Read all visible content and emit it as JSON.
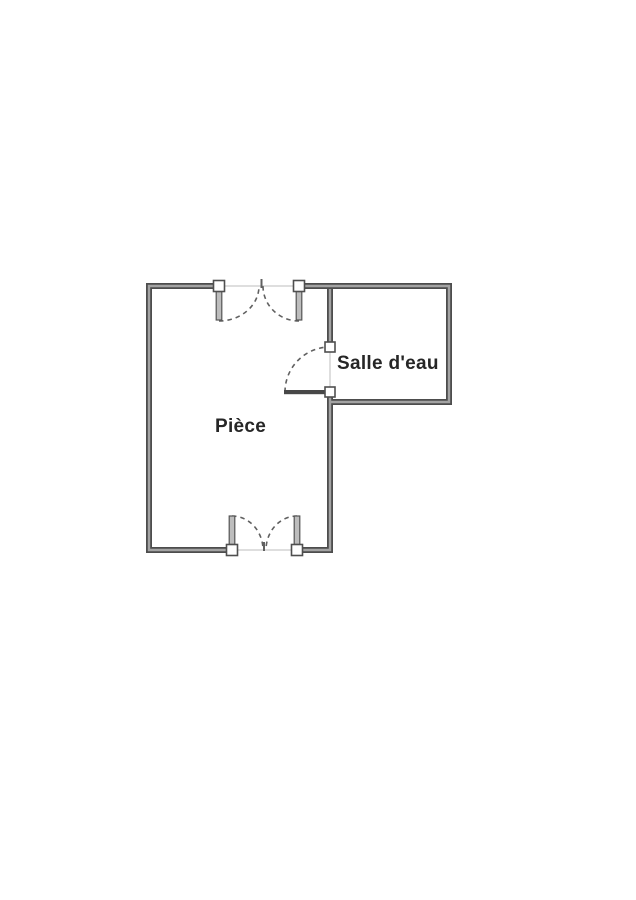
{
  "floor_plan": {
    "rooms": [
      {
        "id": "piece",
        "label": "Pièce"
      },
      {
        "id": "salle-deau",
        "label": "Salle d'eau"
      }
    ]
  },
  "colors": {
    "background": "#ffffff",
    "wall_outer": "#4d4d4d",
    "wall_core": "#a3a3a3",
    "opening_line": "#c9c9c9",
    "jamb_fill": "#ffffff",
    "jamb_outline": "#4f4f4f",
    "door_leaf_fill": "#bdbdbd",
    "door_leaf_outline": "#555555",
    "door_leaf_dark": "#474747",
    "swing_arc": "#606060",
    "text": "#262626"
  }
}
